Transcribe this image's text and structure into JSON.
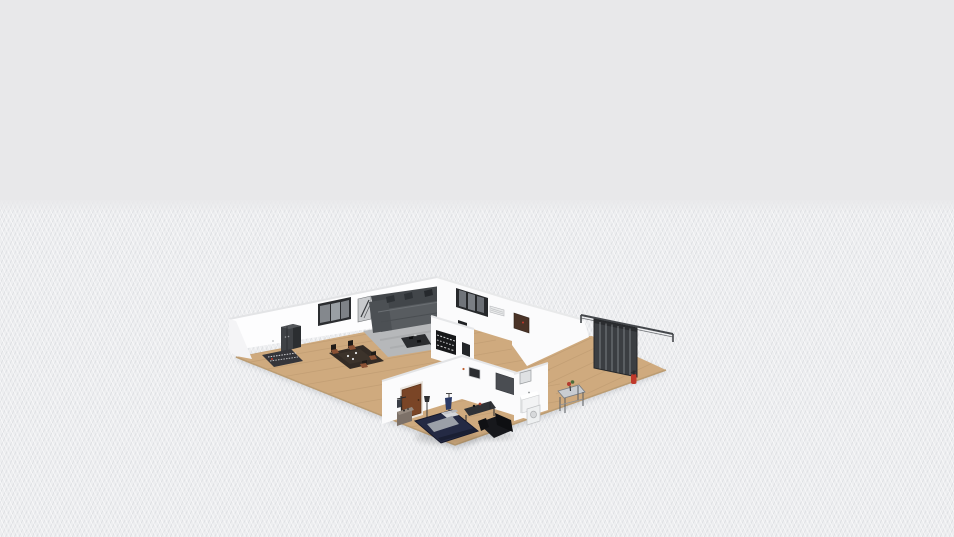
{
  "app": {
    "view": "3d-floorplan-orbit-view"
  },
  "canvas": {
    "width": 954,
    "height": 537,
    "horizon_y": 200
  },
  "colors": {
    "sky": "#e8e8ea",
    "ground": "#edeef0",
    "wall": "#fbfbfc",
    "wall_bright": "#fdfdfe",
    "wall_top": "#e3e4e6",
    "wood": "#cfaa7e",
    "wood_line": "#a8875f",
    "wood_edge": "#bb9c72",
    "rug_gray": "#b6b8ba",
    "sofa_gray": "#585c60",
    "sofa_back_gray": "#42464a",
    "pillow_dark": "#2e3236",
    "cabinet_dark": "#3f4246",
    "window_frame": "#2b2d30",
    "window_glass": "#84888d",
    "dining_dark": "#332b25",
    "chair_seat": "#8a5134",
    "shelf_black": "#17181a",
    "bed_navy": "#242a44",
    "blanket_gray": "#9ba0a8",
    "door_brown": "#7a4526",
    "sofa_black": "#17181c",
    "desk_dark": "#303236",
    "tv_gray": "#4a4d52",
    "fixture_white": "#f2f3f4",
    "slat_dark": "#3b3e42",
    "rail_dark": "#44474b",
    "extinguisher_red": "#c0392b",
    "brown_panel": "#4a3327",
    "garment_blue": "#2b3a66",
    "art_gray": "#c8cacd"
  },
  "scene": {
    "type": "isometric-3d-home-render",
    "rooms": [
      {
        "name": "living-dining-room",
        "objects": [
          "tall-cabinet",
          "window-3-pane",
          "wall-art",
          "sectional-sofa",
          "sofa-pillows",
          "area-rug",
          "coffee-table",
          "dining-table",
          "dining-chairs",
          "plates",
          "keyboard-rug",
          "wall-sconce"
        ]
      },
      {
        "name": "hallway-core",
        "objects": [
          "bookshelf",
          "wall-panel-black",
          "window-2",
          "ac-grille",
          "wall-switch",
          "brown-wall-cabinet"
        ]
      },
      {
        "name": "bedroom",
        "objects": [
          "interior-door",
          "coat-rack",
          "dresser",
          "floor-lamp",
          "clothes-stand",
          "blue-garment",
          "double-bed",
          "blanket",
          "pillows",
          "desk",
          "black-loveseat",
          "wall-art-small",
          "accent-dot"
        ]
      },
      {
        "name": "bathroom",
        "objects": [
          "mirror-cabinet",
          "sink-vanity",
          "washer"
        ]
      },
      {
        "name": "terrace-room",
        "objects": [
          "sliding-rail",
          "slatted-door",
          "fire-extinguisher",
          "console-table",
          "flower-vase"
        ]
      }
    ]
  }
}
